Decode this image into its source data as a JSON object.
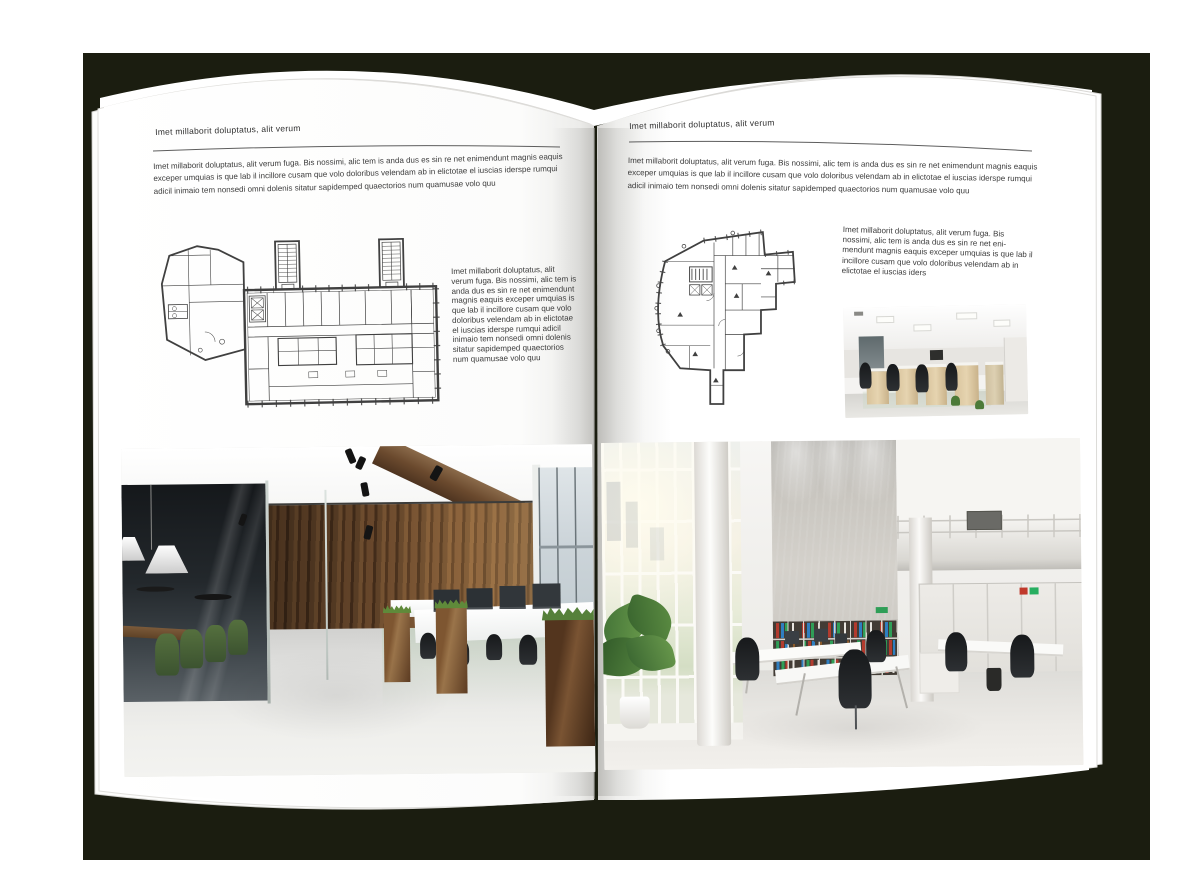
{
  "palette": {
    "backdrop": "#1b1d10",
    "paper": "#ffffff",
    "ink": "#3b3b3b",
    "plan_ink": "#404040",
    "wood": "#7a5433",
    "plant_green": "#5f8a3a",
    "binder_red": "#b23b2e",
    "binder_blue": "#2f7fc1",
    "binder_green": "#2f9e57"
  },
  "left_page": {
    "header": "Imet millaborit doluptatus, alit verum",
    "intro": "Imet millaborit doluptatus, alit verum fuga. Bis nossimi, alic tem is anda dus es sin re net enimendunt magnis eaquis exceper umquias is que lab il incillore cusam que volo doloribus velendam ab in elictotae el iuscias iderspe rumqui adicil inimaio tem nonsedi omni dolenis sitatur sapidemped quaectorios num quamusae volo quu",
    "side_text": "Imet millaborit doluptatus, alit verum fuga. Bis nossimi, alic tem is anda dus es sin re net enimendunt magnis eaquis exceper umquias is que lab il incillore cusam que volo doloribus velendam ab in elictotae el iuscias iderspe rumqui adicil inimaio tem nonsedi omni dolenis sitatur sapidemped quaectorios num quamusae volo quu"
  },
  "right_page": {
    "header": "Imet millaborit doluptatus, alit verum",
    "intro": "Imet millaborit doluptatus, alit verum fuga. Bis nossimi, alic tem is anda dus es sin re net enimendunt magnis eaquis exceper umquias is que lab il incillore cusam que volo doloribus velendam ab in elictotae el iuscias iderspe rumqui adicil inimaio tem nonsedi omni dolenis sitatur sapidemped quaectorios num quamusae volo quu",
    "side_text": "Imet millaborit doluptatus, alit verum fuga. Bis nossimi, alic tem is anda dus es sin re net eni- mendunt magnis eaquis exceper umquias is que lab il incillore cusam que volo doloribus velendam ab in elictotae el iuscias iders"
  },
  "figures": {
    "left_floorplan": "floor-plan-drawing",
    "right_floorplan": "floor-plan-drawing",
    "left_photo": "loft-office-interior-photo",
    "right_photo": "atrium-office-interior-photo",
    "small_photo": "open-space-office-photo"
  }
}
